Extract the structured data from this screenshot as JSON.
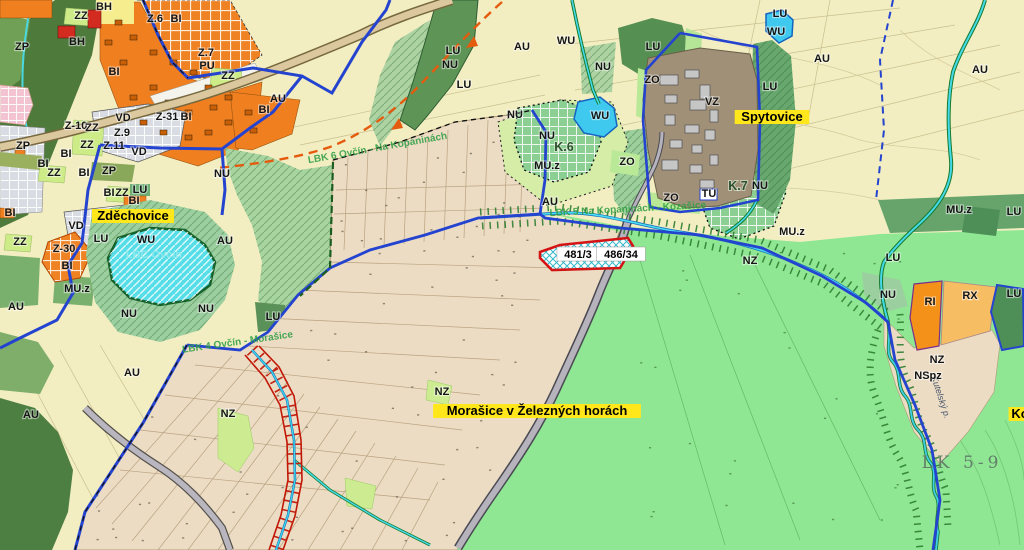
{
  "map_type": "zoning-cadastral-map",
  "colors": {
    "field_pale": "#f2eec2",
    "cadastral_beige": "#ecdcc4",
    "meadow_green": "#8fe693",
    "forest_dark": "#4e7a3c",
    "water_cyan": "#55dde8",
    "residential_orange": "#ef7f1f",
    "housing_red": "#d32b1f",
    "boundary_blue": "#2443cf",
    "parcel_red": "#d41414",
    "corridor_green": "#2e7d32",
    "industry_gray": "#9f9077",
    "highlight_yellow": "#ffe71c"
  },
  "labels": {
    "places": [
      {
        "text": "Zděchovice",
        "x": 133,
        "y": 220,
        "bg": "#ffe71c",
        "big": true
      },
      {
        "text": "Spytovice",
        "x": 772,
        "y": 121,
        "bg": "#ffe71c",
        "big": true
      },
      {
        "text": "Morašice v Železných horách",
        "x": 537,
        "y": 415,
        "bg": "#ffe71c",
        "big": true
      },
      {
        "text": "Ko",
        "x": 1020,
        "y": 418,
        "bg": "#ffe71c",
        "big": true
      }
    ],
    "parcels": [
      {
        "text": "481/3",
        "x": 578,
        "y": 258,
        "bg": "#ffffff"
      },
      {
        "text": "486/34",
        "x": 621,
        "y": 258,
        "bg": "#ffffff"
      }
    ],
    "zones": [
      {
        "text": "ZP",
        "x": 22,
        "y": 50
      },
      {
        "text": "BH",
        "x": 104,
        "y": 10
      },
      {
        "text": "ZZ",
        "x": 81,
        "y": 19
      },
      {
        "text": "Z.6",
        "x": 155,
        "y": 22
      },
      {
        "text": "BI",
        "x": 176,
        "y": 22
      },
      {
        "text": "BH",
        "x": 77,
        "y": 45
      },
      {
        "text": "Z.7",
        "x": 206,
        "y": 56
      },
      {
        "text": "PU",
        "x": 207,
        "y": 69
      },
      {
        "text": "ZZ",
        "x": 228,
        "y": 79
      },
      {
        "text": "BI",
        "x": 114,
        "y": 75
      },
      {
        "text": "AU",
        "x": 278,
        "y": 102
      },
      {
        "text": "BI",
        "x": 264,
        "y": 113
      },
      {
        "text": "VD",
        "x": 123,
        "y": 121
      },
      {
        "text": "Z-10",
        "x": 76,
        "y": 129
      },
      {
        "text": "Z.9",
        "x": 122,
        "y": 136
      },
      {
        "text": "Z-31",
        "x": 167,
        "y": 120
      },
      {
        "text": "BI",
        "x": 186,
        "y": 120
      },
      {
        "text": "ZZ",
        "x": 92,
        "y": 131
      },
      {
        "text": "ZZ",
        "x": 87,
        "y": 148
      },
      {
        "text": "Z.11",
        "x": 114,
        "y": 149
      },
      {
        "text": "ZP",
        "x": 23,
        "y": 149
      },
      {
        "text": "BI",
        "x": 66,
        "y": 157
      },
      {
        "text": "BI",
        "x": 43,
        "y": 167
      },
      {
        "text": "ZZ",
        "x": 54,
        "y": 176
      },
      {
        "text": "BI",
        "x": 84,
        "y": 176
      },
      {
        "text": "ZP",
        "x": 109,
        "y": 174
      },
      {
        "text": "BI",
        "x": 109,
        "y": 196
      },
      {
        "text": "ZZ",
        "x": 122,
        "y": 196
      },
      {
        "text": "LU",
        "x": 140,
        "y": 193
      },
      {
        "text": "NU",
        "x": 222,
        "y": 177
      },
      {
        "text": "BI",
        "x": 10,
        "y": 216
      },
      {
        "text": "ZZ",
        "x": 20,
        "y": 245
      },
      {
        "text": "VD",
        "x": 76,
        "y": 229
      },
      {
        "text": "VD",
        "x": 139,
        "y": 155
      },
      {
        "text": "LU",
        "x": 101,
        "y": 242
      },
      {
        "text": "Z-30",
        "x": 64,
        "y": 252
      },
      {
        "text": "BI",
        "x": 67,
        "y": 269
      },
      {
        "text": "MU.z",
        "x": 77,
        "y": 292
      },
      {
        "text": "AU",
        "x": 16,
        "y": 310
      },
      {
        "text": "WU",
        "x": 146,
        "y": 243
      },
      {
        "text": "AU",
        "x": 225,
        "y": 244
      },
      {
        "text": "BI",
        "x": 134,
        "y": 204
      },
      {
        "text": "NU",
        "x": 129,
        "y": 317
      },
      {
        "text": "NU",
        "x": 206,
        "y": 312
      },
      {
        "text": "LU",
        "x": 273,
        "y": 320
      },
      {
        "text": "AU",
        "x": 31,
        "y": 418
      },
      {
        "text": "AU",
        "x": 132,
        "y": 376
      },
      {
        "text": "NZ",
        "x": 228,
        "y": 417
      },
      {
        "text": "NZ",
        "x": 442,
        "y": 395
      },
      {
        "text": "LU",
        "x": 453,
        "y": 54
      },
      {
        "text": "NU",
        "x": 450,
        "y": 68
      },
      {
        "text": "LU",
        "x": 464,
        "y": 88
      },
      {
        "text": "AU",
        "x": 522,
        "y": 50
      },
      {
        "text": "WU",
        "x": 566,
        "y": 44
      },
      {
        "text": "NU",
        "x": 603,
        "y": 70
      },
      {
        "text": "LU",
        "x": 653,
        "y": 50
      },
      {
        "text": "ZO",
        "x": 652,
        "y": 83
      },
      {
        "text": "WU",
        "x": 600,
        "y": 119
      },
      {
        "text": "NU",
        "x": 547,
        "y": 139
      },
      {
        "text": "K.6",
        "x": 564,
        "y": 151,
        "cls": "lbl-k"
      },
      {
        "text": "NU",
        "x": 515,
        "y": 118
      },
      {
        "text": "MU.z",
        "x": 547,
        "y": 169
      },
      {
        "text": "ZO",
        "x": 627,
        "y": 165
      },
      {
        "text": "AU",
        "x": 550,
        "y": 205
      },
      {
        "text": "VZ",
        "x": 712,
        "y": 105
      },
      {
        "text": "WU",
        "x": 776,
        "y": 35
      },
      {
        "text": "LU",
        "x": 780,
        "y": 17
      },
      {
        "text": "AU",
        "x": 822,
        "y": 62
      },
      {
        "text": "AU",
        "x": 980,
        "y": 73
      },
      {
        "text": "LU",
        "x": 770,
        "y": 90
      },
      {
        "text": "K.7",
        "x": 738,
        "y": 190,
        "cls": "lbl-k"
      },
      {
        "text": "NU",
        "x": 760,
        "y": 189
      },
      {
        "text": "TU",
        "x": 709,
        "y": 197
      },
      {
        "text": "ZO",
        "x": 671,
        "y": 201
      },
      {
        "text": "MU.z",
        "x": 959,
        "y": 213
      },
      {
        "text": "LU",
        "x": 1014,
        "y": 215
      },
      {
        "text": "MU.z",
        "x": 792,
        "y": 235
      },
      {
        "text": "LU",
        "x": 893,
        "y": 261
      },
      {
        "text": "NU",
        "x": 888,
        "y": 298
      },
      {
        "text": "RI",
        "x": 930,
        "y": 305
      },
      {
        "text": "RX",
        "x": 970,
        "y": 299
      },
      {
        "text": "LU",
        "x": 1014,
        "y": 297
      },
      {
        "text": "NZ",
        "x": 937,
        "y": 363
      },
      {
        "text": "NSpz",
        "x": 928,
        "y": 379
      },
      {
        "text": "NZ",
        "x": 750,
        "y": 264
      }
    ],
    "corridors": [
      {
        "text": "LBK 6 Ovčín - Na Kopaninách",
        "x": 378,
        "y": 151,
        "rot": -10,
        "cls": "lbl-lbk"
      },
      {
        "text": "LBK 5 Na Kopaninách - Kozašice",
        "x": 628,
        "y": 212,
        "rot": -3,
        "cls": "lbl-lbk"
      },
      {
        "text": "LBK 4 Ovčín - Morašice",
        "x": 238,
        "y": 345,
        "rot": -8,
        "cls": "lbl-lbk"
      },
      {
        "text": "LBC Ovčín",
        "x": 154,
        "y": 258,
        "cls": "lbl-lbc"
      },
      {
        "text": "LK 5-9",
        "x": 962,
        "y": 468,
        "cls": "lbl-lk"
      },
      {
        "text": "Kutelský p.",
        "x": 938,
        "y": 398,
        "rot": 72,
        "cls": "lbl-stream"
      }
    ]
  }
}
